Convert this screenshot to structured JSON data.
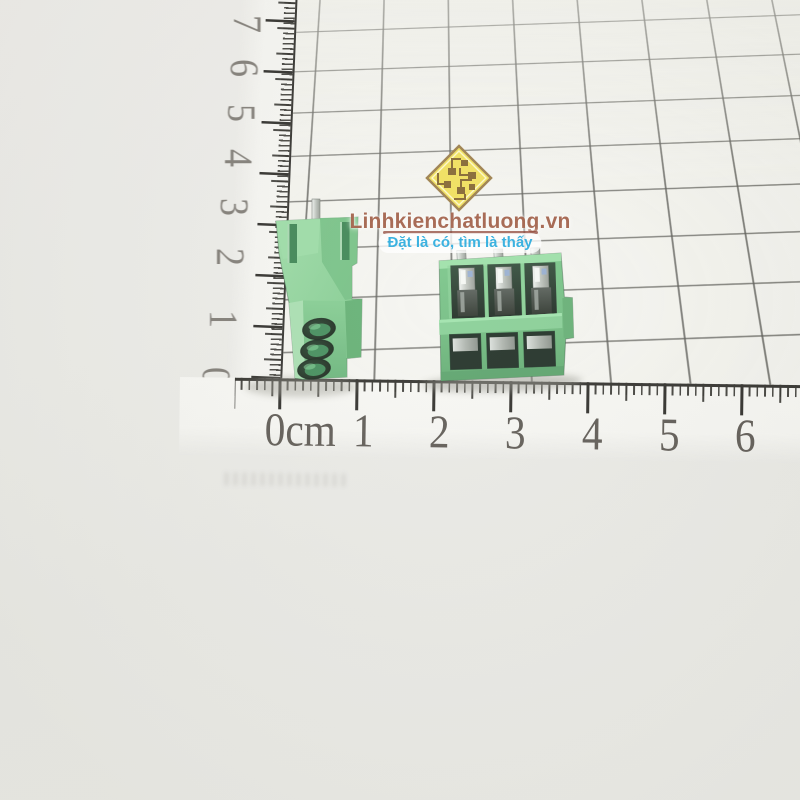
{
  "photo": {
    "type": "product-photo",
    "subject": "Two green 3-pin screw terminal blocks photographed on grid paper behind a corner centimeter ruler",
    "background_color": "#e9e9e5",
    "grid_paper_color": "#f2f2ec",
    "grid_line_color": "#2a2a24"
  },
  "watermark": {
    "logo_icon": "circuit-diamond-logo",
    "logo_fill_color": "#efdd4f",
    "logo_border_color": "#94743c",
    "logo_trace_color": "#7a5a20",
    "title": "Linhkienchatluong.vn",
    "title_color": "#964c32",
    "subtitle": "Đặt là có, tìm là thấy",
    "subtitle_color": "#1ca6dc"
  },
  "ruler": {
    "unit": "cm",
    "horizontal_labels": [
      "0cm",
      "1",
      "2",
      "3",
      "4",
      "5",
      "6"
    ],
    "vertical_labels": [
      "7",
      "6",
      "5",
      "4",
      "3",
      "2",
      "1",
      "0"
    ],
    "tick_color": "#23221e",
    "number_color": "#45403a"
  },
  "objects": {
    "left_block": {
      "name": "terminal-block-side-view",
      "positions": 3,
      "body_color": "#7cc98a",
      "hole_color": "#0c1b10"
    },
    "right_block": {
      "name": "terminal-block-front-view",
      "positions": 3,
      "body_color": "#6cbf7d",
      "metal_color": "#c2c8c2"
    }
  }
}
